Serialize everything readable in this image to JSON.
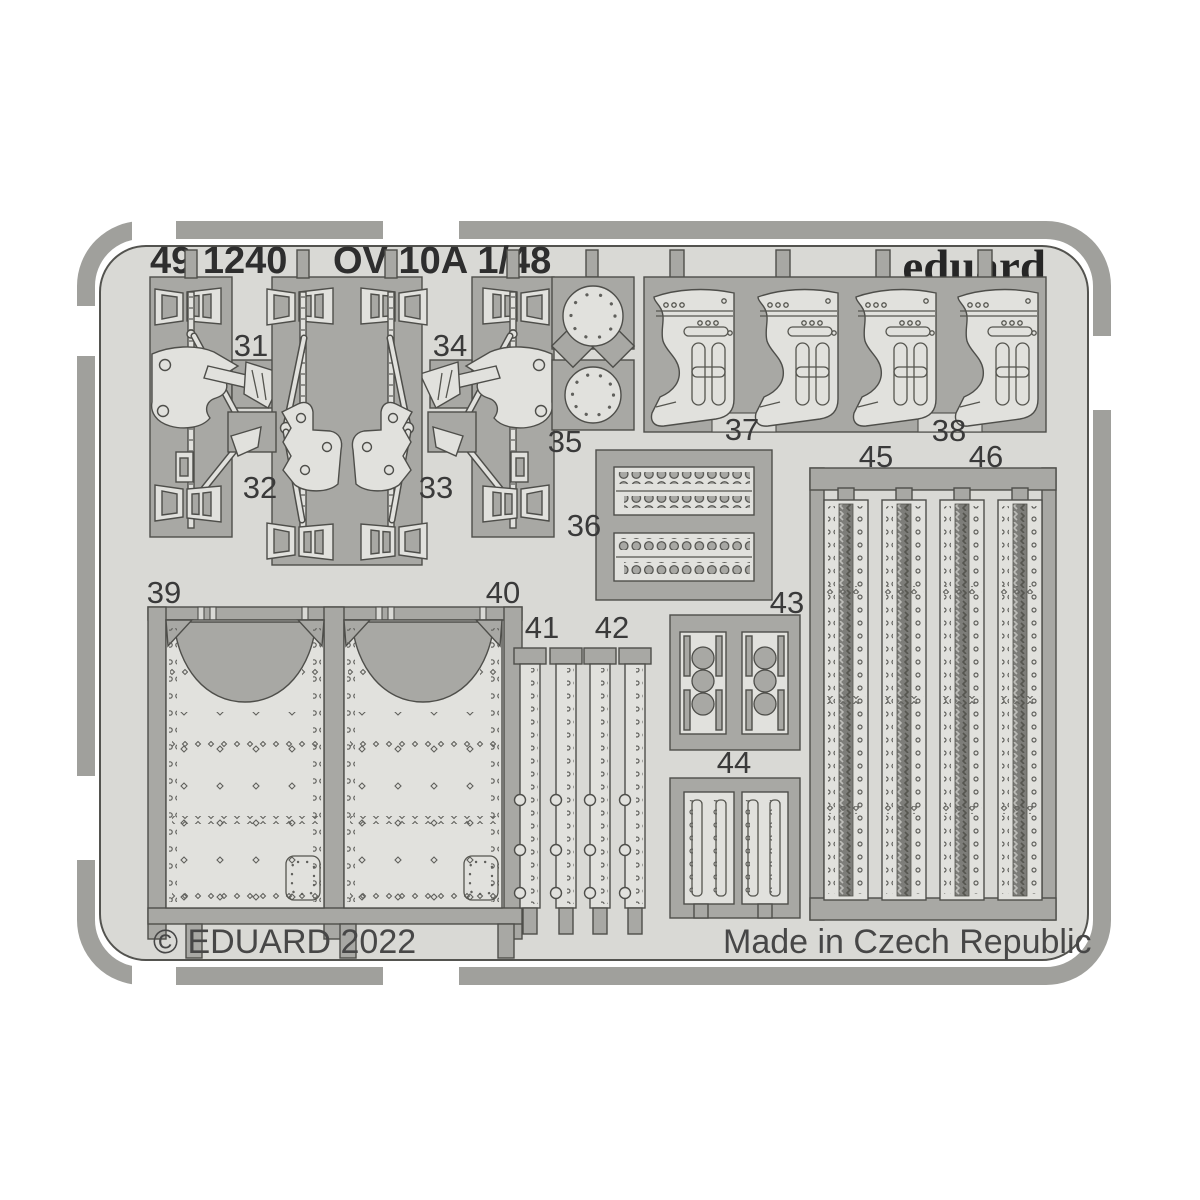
{
  "header": {
    "code": "49 1240",
    "title": "OV-10A 1/48",
    "brand": "eduard"
  },
  "footer": {
    "copyright": "© EDUARD 2022",
    "origin": "Made in Czech Republic"
  },
  "part_labels": {
    "p31": "31",
    "p32": "32",
    "p33": "33",
    "p34": "34",
    "p35": "35",
    "p36": "36",
    "p37": "37",
    "p38": "38",
    "p39": "39",
    "p40": "40",
    "p41": "41",
    "p42": "42",
    "p43": "43",
    "p44": "44",
    "p45": "45",
    "p46": "46"
  },
  "colors": {
    "sheet": "#d9d9d5",
    "waste": "#a8a8a4",
    "part": "#e1e1dd",
    "outline": "#4e4e4a",
    "rail": "#a0a09c",
    "text": "#2e2e2e"
  }
}
